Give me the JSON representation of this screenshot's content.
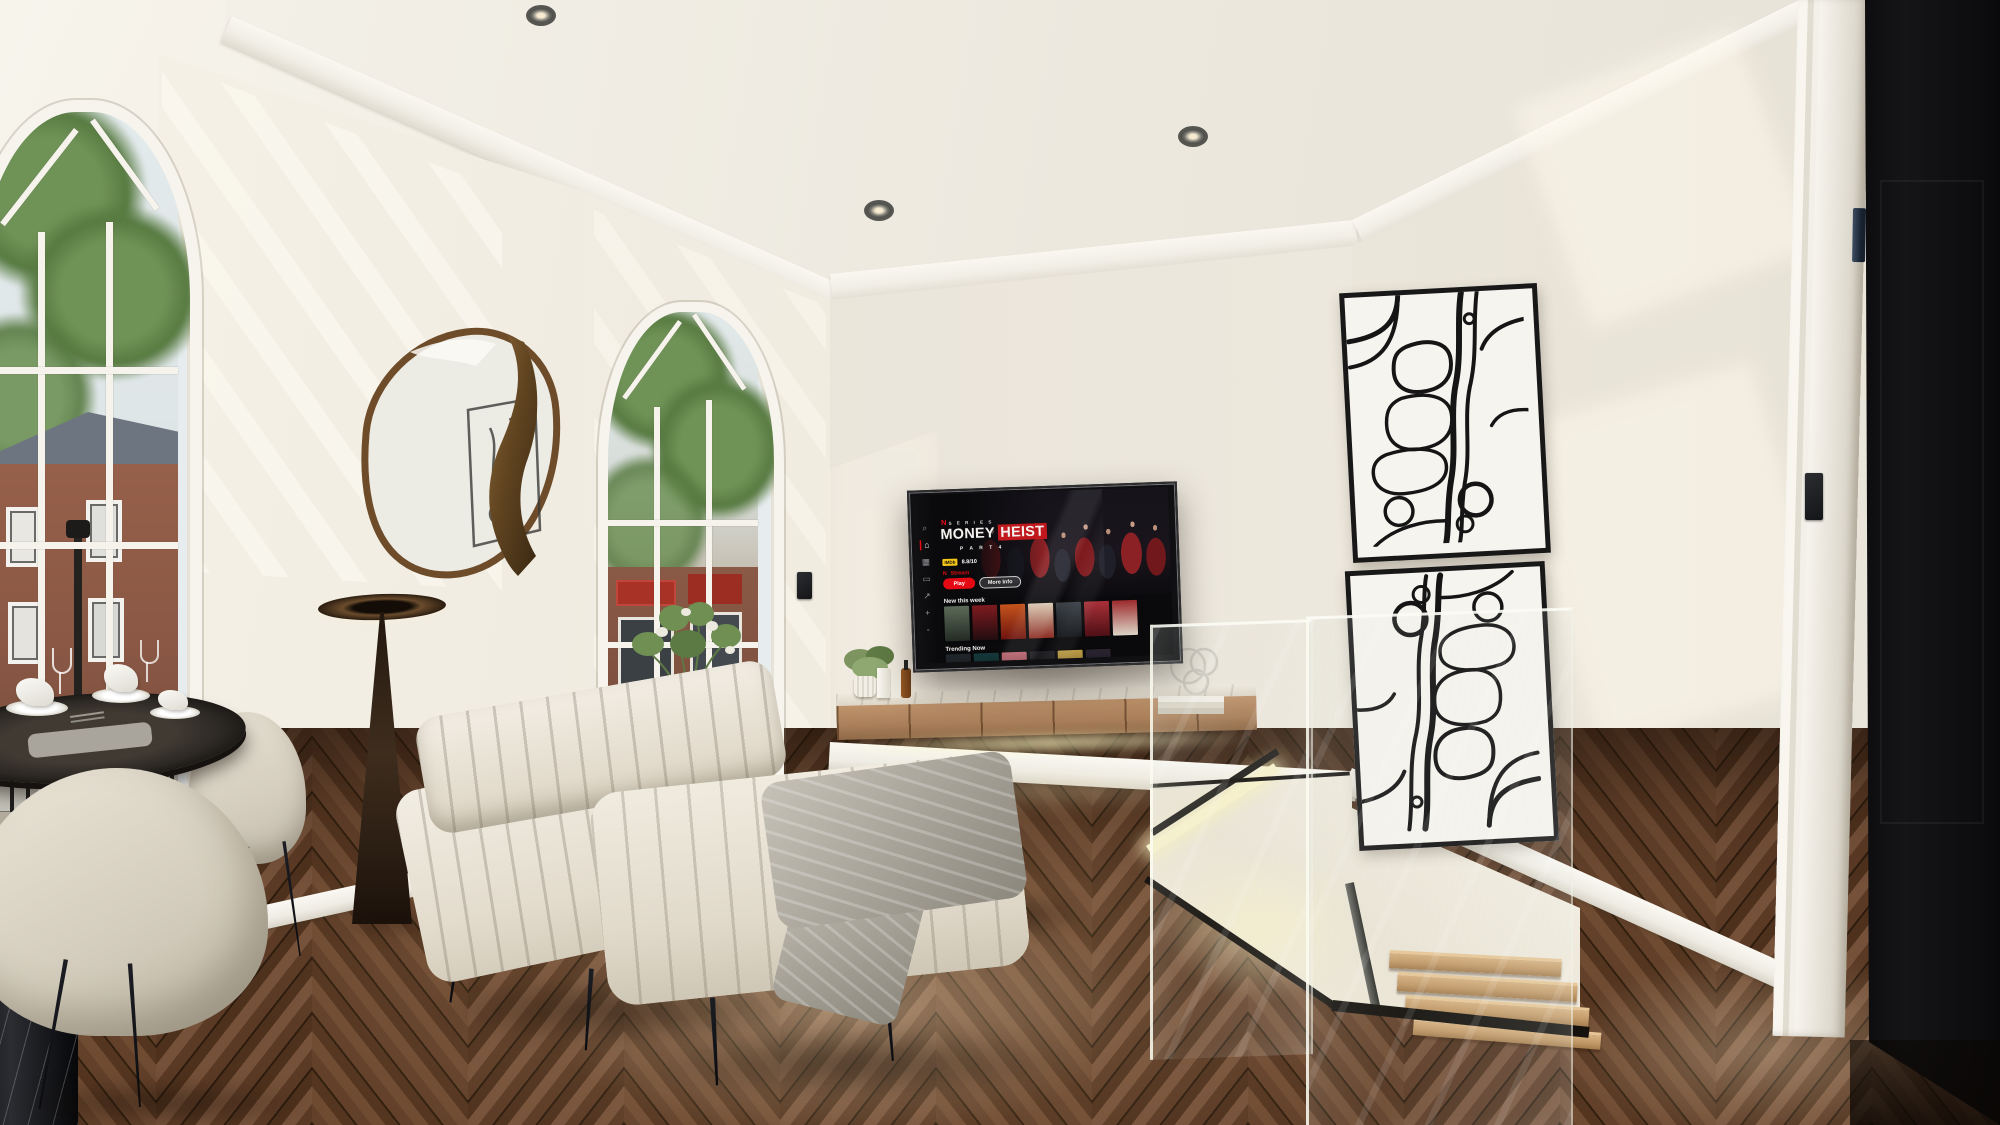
{
  "tv": {
    "brand_badge": "N",
    "brand_label": "S E R I E S",
    "title_word1": "MONEY",
    "title_word2": "HEIST",
    "subtitle": "P A R T  4",
    "rating_badge": "IMDb",
    "rating_value": "8.8/10",
    "stream_badge": "N",
    "stream_label": "Stream",
    "play_label": "Play",
    "more_info_label": "More Info",
    "row1_title": "New this week",
    "row2_title": "Trending Now",
    "sidebar_icons": [
      {
        "name": "search-icon",
        "glyph": "⌕"
      },
      {
        "name": "home-icon",
        "glyph": "⌂"
      },
      {
        "name": "shows-icon",
        "glyph": "▦"
      },
      {
        "name": "movies-icon",
        "glyph": "▭"
      },
      {
        "name": "new-icon",
        "glyph": "↗"
      },
      {
        "name": "mylist-icon",
        "glyph": "+"
      },
      {
        "name": "profile-icon",
        "glyph": "◦"
      }
    ],
    "row1_poster_colors": [
      [
        "#5c6a58",
        "#232b24"
      ],
      [
        "#7e1b1f",
        "#220d10"
      ],
      [
        "#c4541c",
        "#6e130e"
      ],
      [
        "#d9c9b2",
        "#8c2c22"
      ],
      [
        "#3a4046",
        "#121418"
      ],
      [
        "#a93038",
        "#4e0f15"
      ],
      [
        "#9c2a2d",
        "#dcd4c6"
      ]
    ],
    "row2_poster_colors": [
      [
        "#20262b",
        "#0e1114"
      ],
      [
        "#15383a",
        "#081a1c"
      ],
      [
        "#b8646e",
        "#5e2730"
      ],
      [
        "#1e1e22",
        "#0c0c0e"
      ],
      [
        "#b99a45",
        "#5e4a16"
      ],
      [
        "#2a2430",
        "#120f16"
      ]
    ]
  },
  "palette": {
    "netflix_red": "#e50914",
    "imdb_yellow": "#f5c518",
    "led_glow": "#f5efc2",
    "wall": "#ebe6da",
    "floor_wood": "#5d3b25",
    "door": "#0d0d0f",
    "upholstery": "#e8e2d4",
    "console_wood": "#b48a63",
    "art_line": "#151515"
  }
}
